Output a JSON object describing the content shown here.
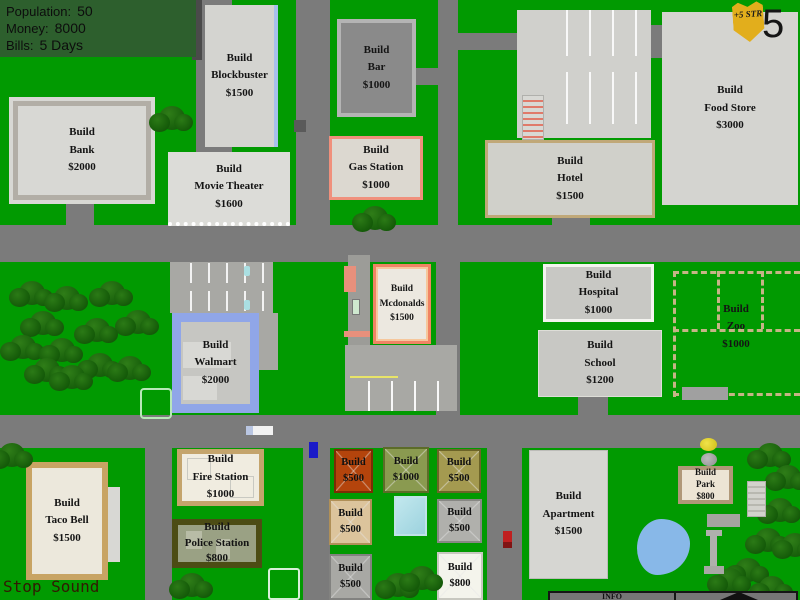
{
  "hud": {
    "population_label": "Population:",
    "population_value": "50",
    "money_label": "Money:",
    "money_value": "8000",
    "bills_label": "Bills:",
    "bills_value": "5 Days"
  },
  "level_badge": {
    "bonus": "+5",
    "stat": "STR",
    "level": "5"
  },
  "buildings": {
    "bank": {
      "action": "Build",
      "name": "Bank",
      "price": "$2000"
    },
    "blockbuster": {
      "action": "Build",
      "name": "Blockbuster",
      "price": "$1500"
    },
    "movie_theater": {
      "action": "Build",
      "name": "Movie Theater",
      "price": "$1600"
    },
    "bar": {
      "action": "Build",
      "name": "Bar",
      "price": "$1000"
    },
    "gas_station": {
      "action": "Build",
      "name": "Gas Station",
      "price": "$1000"
    },
    "hotel": {
      "action": "Build",
      "name": "Hotel",
      "price": "$1500"
    },
    "food_store": {
      "action": "Build",
      "name": "Food Store",
      "price": "$3000"
    },
    "mcdonalds": {
      "action": "Build",
      "name": "Mcdonalds",
      "price": "$1500"
    },
    "hospital": {
      "action": "Build",
      "name": "Hospital",
      "price": "$1000"
    },
    "school": {
      "action": "Build",
      "name": "School",
      "price": "$1200"
    },
    "zoo": {
      "action": "Build",
      "name": "Zoo",
      "price": "$1000"
    },
    "walmart": {
      "action": "Build",
      "name": "Walmart",
      "price": "$2000"
    },
    "taco_bell": {
      "action": "Build",
      "name": "Taco Bell",
      "price": "$1500"
    },
    "fire_station": {
      "action": "Build",
      "name": "Fire Station",
      "price": "$1000"
    },
    "police_station": {
      "action": "Build",
      "name": "Police Station",
      "price": "$800"
    },
    "apartment": {
      "action": "Build",
      "name": "Apartment",
      "price": "$1500"
    },
    "park": {
      "action": "Build",
      "name": "Park",
      "price": "$800"
    }
  },
  "houses": [
    {
      "action": "Build",
      "price": "$500"
    },
    {
      "action": "Build",
      "price": "$1000"
    },
    {
      "action": "Build",
      "price": "$500"
    },
    {
      "action": "Build",
      "price": "$500"
    },
    {
      "action": "Build",
      "price": "$500"
    },
    {
      "action": "Build",
      "price": "$500"
    },
    {
      "action": "Build",
      "price": "$800"
    }
  ],
  "footer": {
    "stop_sound": "Stop Sound",
    "info": "INFO"
  },
  "colors": {
    "grass": "#019a01",
    "road": "#7b7b7b",
    "hud_panel": "#2d5f2d",
    "badge_gold": "#e2ae1c",
    "walmart_blue": "#90a6e8",
    "mcdonalds_salmon": "#f08464",
    "pond_blue": "#88b8e8"
  }
}
